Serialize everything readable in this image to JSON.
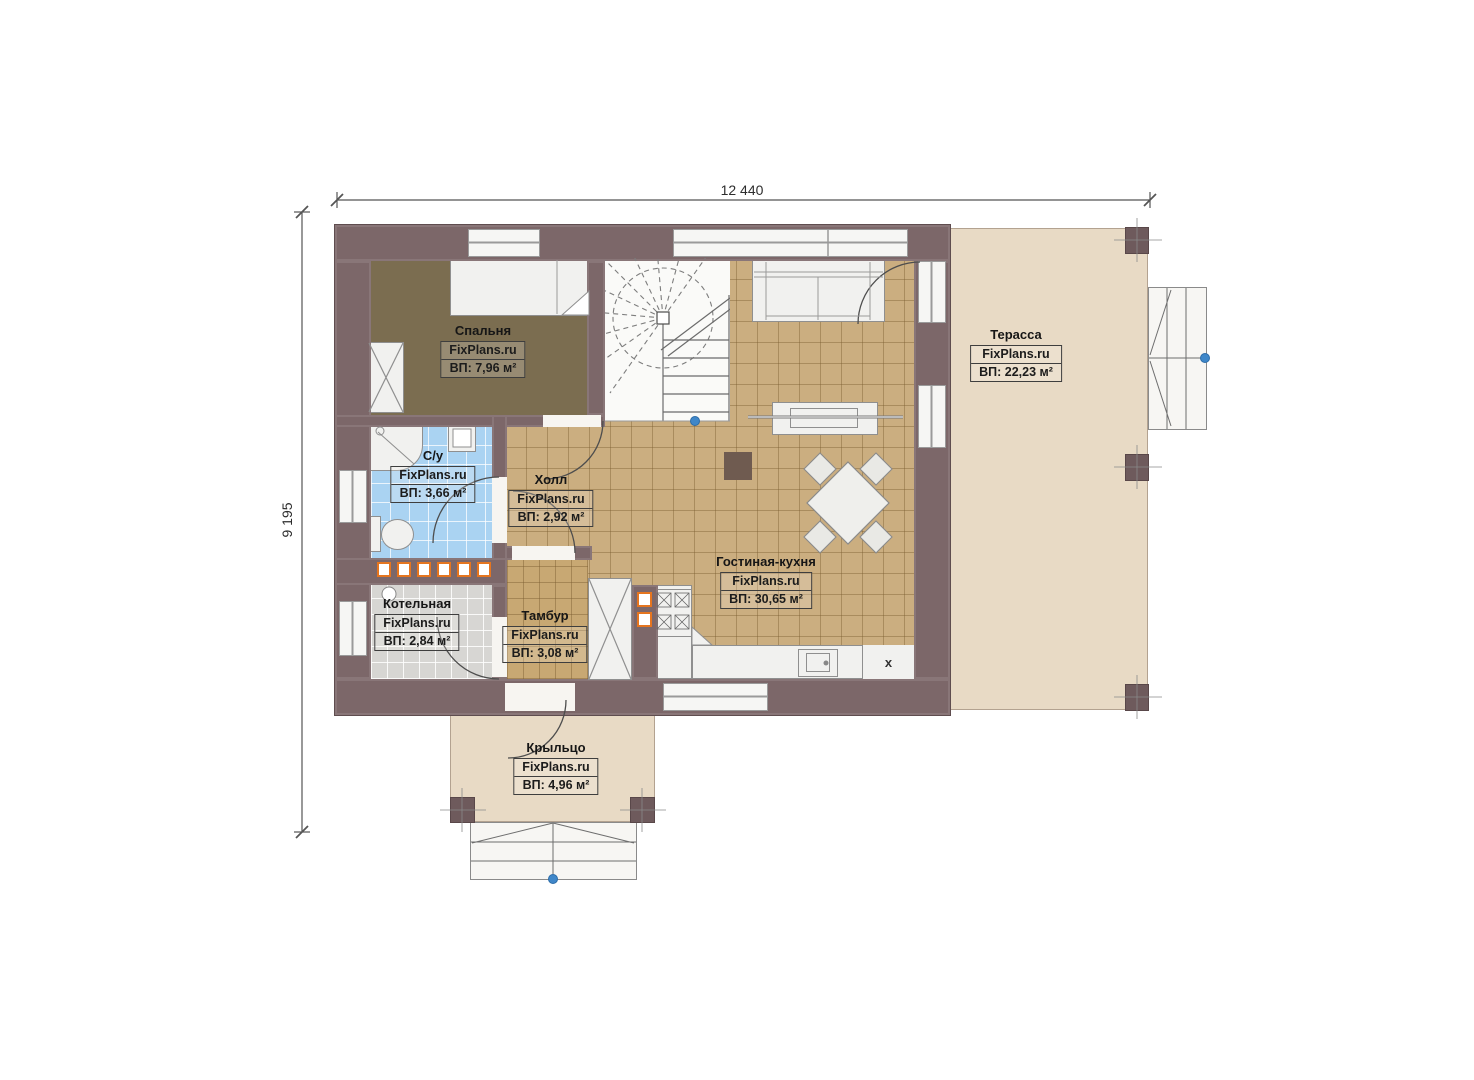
{
  "dimensions": {
    "width_label": "12 440",
    "height_label": "9 195"
  },
  "rooms": {
    "bedroom": {
      "name": "Спальня",
      "brand": "FixPlans.ru",
      "area": "ВП: 7,96 м²"
    },
    "bathroom": {
      "name": "С/у",
      "brand": "FixPlans.ru",
      "area": "ВП: 3,66 м²"
    },
    "hall": {
      "name": "Холл",
      "brand": "FixPlans.ru",
      "area": "ВП: 2,92 м²"
    },
    "boiler": {
      "name": "Котельная",
      "brand": "FixPlans.ru",
      "area": "ВП: 2,84 м²"
    },
    "vestibule": {
      "name": "Тамбур",
      "brand": "FixPlans.ru",
      "area": "ВП: 3,08 м²"
    },
    "living_kitchen": {
      "name": "Гостиная-кухня",
      "brand": "FixPlans.ru",
      "area": "ВП: 30,65 м²"
    },
    "terrace": {
      "name": "Терасса",
      "brand": "FixPlans.ru",
      "area": "ВП: 22,23 м²"
    },
    "porch": {
      "name": "Крыльцо",
      "brand": "FixPlans.ru",
      "area": "ВП: 4,96 м²"
    }
  },
  "kitchen": {
    "fridge_marker": "x"
  },
  "palette": {
    "wall": "#7c6769",
    "floor_tan": "#cbae80",
    "floor_bedroom": "#7b6d50",
    "floor_bath": "#aad3f2",
    "floor_boiler": "#d7d6d3",
    "deck": "#e8dac5",
    "radiator_accent": "#e5751f",
    "handle_blue": "#3f87c9"
  }
}
